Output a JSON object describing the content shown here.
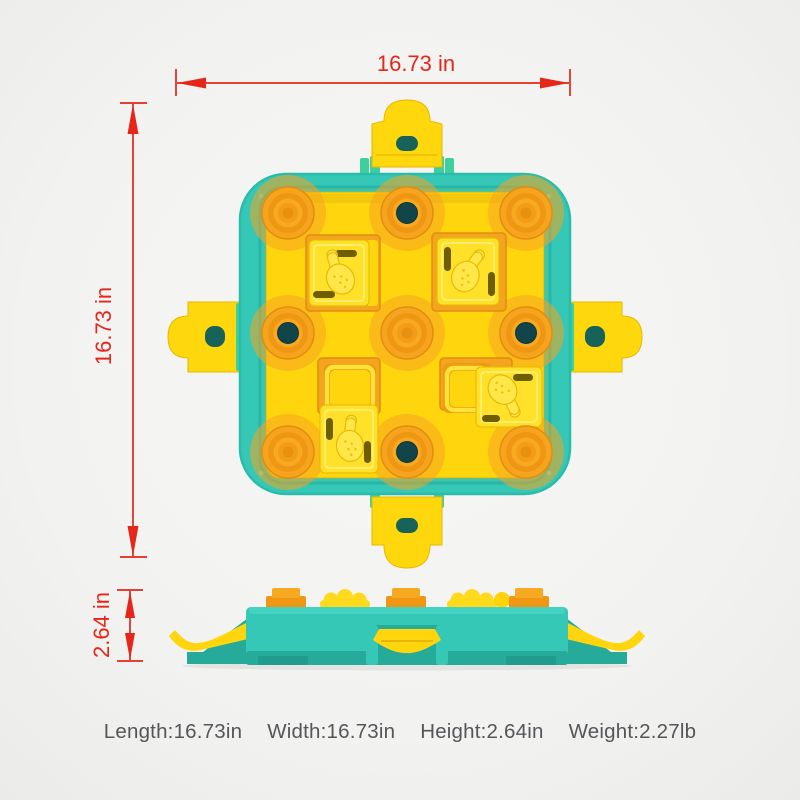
{
  "dimensions": {
    "width": {
      "label": "16.73 in"
    },
    "height": {
      "label": "16.73 in"
    },
    "depth": {
      "label": "2.64 in"
    }
  },
  "specs": {
    "length": "Length:16.73in",
    "width": "Width:16.73in",
    "height": "Height:2.64in",
    "weight": "Weight:2.27lb"
  },
  "colors": {
    "dimension_red": "#e52619",
    "body_teal": "#35c8b7",
    "board_yellow": "#ffd60e",
    "block_yellow": "#ffe129",
    "knob_orange": "#f5a41f",
    "hole_dark_teal": "#124549",
    "spec_text_gray": "#55565a"
  },
  "icons": {
    "drumstick": "drumstick-icon",
    "arrows": "dimension-arrow-icon"
  }
}
